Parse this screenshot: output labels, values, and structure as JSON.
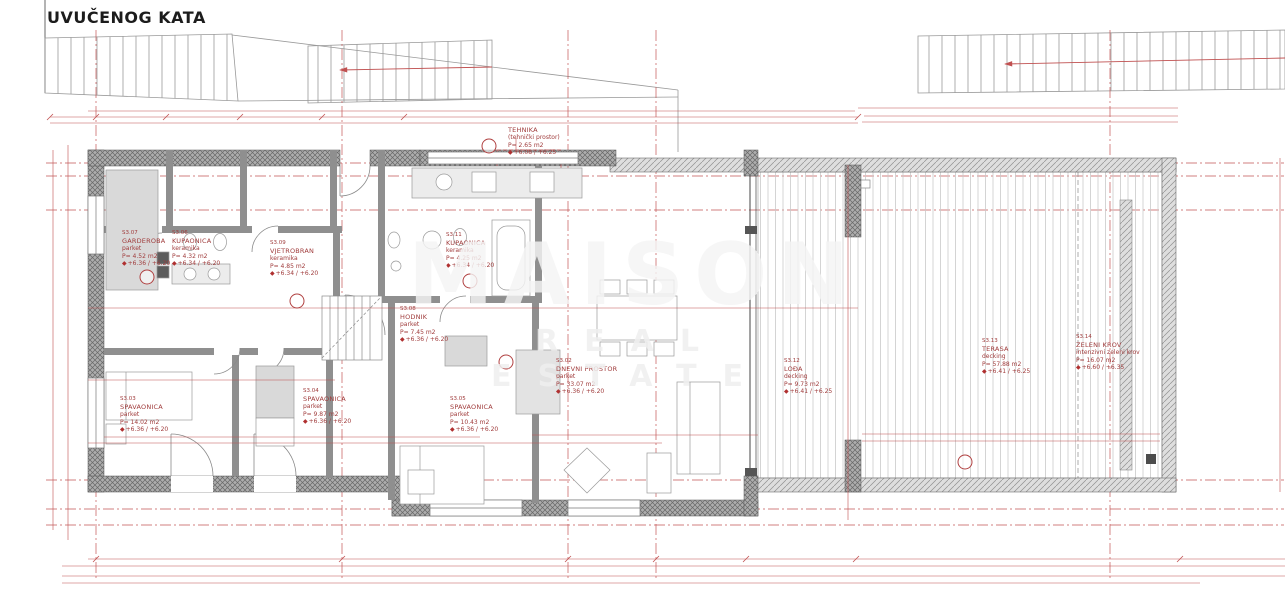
{
  "title": "UVUČENOG KATA",
  "watermark": {
    "line1": "MAISON",
    "line2": "REAL ESTATE"
  },
  "colors": {
    "dimension_red": "#b04040",
    "wall_gray": "#6a6a6a",
    "furniture_gray": "#d9d9d9",
    "deck_gray": "#c9c9c9",
    "background": "#ffffff"
  },
  "grid": {
    "top": [
      {
        "t": "A",
        "x": 96,
        "y": 27
      },
      {
        "t": "B",
        "x": 342,
        "y": 25
      },
      {
        "t": "C",
        "x": 568,
        "y": 25
      },
      {
        "t": "D",
        "x": 656,
        "y": 25
      },
      {
        "t": "E",
        "x": 1110,
        "y": 25
      }
    ],
    "bottom": [
      {
        "t": "A",
        "x": 96,
        "y": 581
      },
      {
        "t": "B",
        "x": 342,
        "y": 581
      },
      {
        "t": "C",
        "x": 568,
        "y": 581
      },
      {
        "t": "D",
        "x": 656,
        "y": 581
      },
      {
        "t": "E",
        "x": 1110,
        "y": 581
      }
    ],
    "left": [
      {
        "t": "6",
        "x": 50,
        "y": 163
      },
      {
        "t": "5",
        "x": 50,
        "y": 176
      },
      {
        "t": "4",
        "x": 50,
        "y": 210
      },
      {
        "t": "3",
        "x": 50,
        "y": 480
      },
      {
        "t": "2",
        "x": 50,
        "y": 509
      },
      {
        "t": "1",
        "x": 50,
        "y": 525
      }
    ],
    "right": [
      {
        "t": "6",
        "x": 1277,
        "y": 163
      },
      {
        "t": "5",
        "x": 1277,
        "y": 176
      },
      {
        "t": "4",
        "x": 1277,
        "y": 210
      },
      {
        "t": "3",
        "x": 1277,
        "y": 480
      },
      {
        "t": "2",
        "x": 1277,
        "y": 509
      },
      {
        "t": "1",
        "x": 1277,
        "y": 525
      }
    ]
  },
  "rooms": [
    {
      "code": "S3.07",
      "name": "GARDEROBA",
      "finish": "parket",
      "area": "P= 4.52 m2",
      "levels": "+6.36 / +6.20",
      "x": 122,
      "y": 230
    },
    {
      "code": "S3.06",
      "name": "KUPAONICA",
      "finish": "keramika",
      "area": "P= 4.32 m2",
      "levels": "+6.34 / +6.20",
      "x": 172,
      "y": 230
    },
    {
      "code": "S3.09",
      "name": "VJETROBRAN",
      "finish": "keramika",
      "area": "P= 4.85 m2",
      "levels": "+6.34 / +6.20",
      "x": 270,
      "y": 240
    },
    {
      "code": "S3.11",
      "name": "KUPAONICA",
      "finish": "keramika",
      "area": "P= 4.25 m2",
      "levels": "+6.34 / +6.20",
      "x": 446,
      "y": 232
    },
    {
      "code": "",
      "name": "TEHNIKA",
      "finish": "(tehnički prostor)",
      "area": "P= 2.65 m2",
      "levels": "+6.08 / +6.25",
      "x": 508,
      "y": 126
    },
    {
      "code": "S3.08",
      "name": "HODNIK",
      "finish": "parket",
      "area": "P= 7.45 m2",
      "levels": "+6.36 / +6.20",
      "x": 400,
      "y": 306
    },
    {
      "code": "S3.02",
      "name": "DNEVNI PROSTOR",
      "finish": "parket",
      "area": "P= 33.07 m2",
      "levels": "+6.36 / +6.20",
      "x": 556,
      "y": 358
    },
    {
      "code": "S3.03",
      "name": "SPAVAONICA",
      "finish": "parket",
      "area": "P= 14.02 m2",
      "levels": "+6.36 / +6.20",
      "x": 120,
      "y": 396
    },
    {
      "code": "S3.04",
      "name": "SPAVAONICA",
      "finish": "parket",
      "area": "P= 9.87 m2",
      "levels": "+6.36 / +6.20",
      "x": 303,
      "y": 388
    },
    {
      "code": "S3.05",
      "name": "SPAVAONICA",
      "finish": "parket",
      "area": "P= 10.43 m2",
      "levels": "+6.36 / +6.20",
      "x": 450,
      "y": 396
    },
    {
      "code": "S3.12",
      "name": "LOĐA",
      "finish": "decking",
      "area": "P= 9.73 m2",
      "levels": "+6.41 / +6.25",
      "x": 784,
      "y": 358
    },
    {
      "code": "S3.13",
      "name": "TERASA",
      "finish": "decking",
      "area": "P= 57.88 m2",
      "levels": "+6.41 / +6.25",
      "x": 982,
      "y": 338
    },
    {
      "code": "S3.14",
      "name": "ZELENI KROV",
      "finish": "intenzivni zeleni krov",
      "area": "P= 16.07 m2",
      "levels": "+6.60 / +6.35",
      "x": 1076,
      "y": 334
    }
  ],
  "dims": [
    {
      "t": "208.5",
      "x": 96,
      "y": 117
    },
    {
      "t": "380",
      "x": 166,
      "y": 111
    },
    {
      "t": "40",
      "x": 188,
      "y": 117
    },
    {
      "t": "111.5",
      "x": 227,
      "y": 117
    },
    {
      "t": "216",
      "x": 172,
      "y": 123
    },
    {
      "t": "16",
      "x": 240,
      "y": 123
    },
    {
      "t": "147",
      "x": 282,
      "y": 112
    },
    {
      "t": "45",
      "x": 261,
      "y": 117
    },
    {
      "t": "38",
      "x": 292,
      "y": 117
    },
    {
      "t": "179",
      "x": 261,
      "y": 123
    },
    {
      "t": "15",
      "x": 323,
      "y": 117
    },
    {
      "t": "226",
      "x": 363,
      "y": 117
    },
    {
      "t": "182",
      "x": 362,
      "y": 123
    },
    {
      "t": "15",
      "x": 404,
      "y": 123
    },
    {
      "t": "640",
      "x": 452,
      "y": 108
    },
    {
      "t": "386",
      "x": 494,
      "y": 115
    },
    {
      "t": "418",
      "x": 494,
      "y": 121
    },
    {
      "t": "25",
      "x": 585,
      "y": 115
    },
    {
      "t": "16",
      "x": 583,
      "y": 121
    },
    {
      "t": "161",
      "x": 623,
      "y": 108
    },
    {
      "t": "831",
      "x": 727,
      "y": 115
    },
    {
      "t": "834",
      "x": 721,
      "y": 121
    },
    {
      "t": "15",
      "x": 855,
      "y": 121
    },
    {
      "t": "1206.5",
      "x": 917,
      "y": 108
    },
    {
      "t": "726.5",
      "x": 1021,
      "y": 116
    },
    {
      "t": "743.5",
      "x": 1019,
      "y": 122
    },
    {
      "t": "76",
      "x": 115,
      "y": 307
    },
    {
      "t": "100",
      "x": 298,
      "y": 307
    },
    {
      "t": "114",
      "x": 428,
      "y": 310
    },
    {
      "t": "90",
      "x": 470,
      "y": 309
    },
    {
      "t": "15",
      "x": 522,
      "y": 310
    },
    {
      "t": "457",
      "x": 636,
      "y": 309
    },
    {
      "t": "110",
      "x": 607,
      "y": 316,
      "r": 1
    },
    {
      "t": "212",
      "x": 797,
      "y": 309
    },
    {
      "t": "303.5",
      "x": 166,
      "y": 379
    },
    {
      "t": "110",
      "x": 227,
      "y": 380
    },
    {
      "t": "42.5",
      "x": 243,
      "y": 380
    },
    {
      "t": "90",
      "x": 307,
      "y": 380
    },
    {
      "t": "350",
      "x": 347,
      "y": 408,
      "r": 1
    },
    {
      "t": "773",
      "x": 51,
      "y": 330,
      "r": 1
    },
    {
      "t": "530.5",
      "x": 727,
      "y": 358,
      "r": 1
    },
    {
      "t": "528.5",
      "x": 840,
      "y": 358,
      "r": 1
    },
    {
      "t": "212",
      "x": 852,
      "y": 300,
      "r": 1
    },
    {
      "t": "338",
      "x": 176,
      "y": 437
    },
    {
      "t": "323",
      "x": 325,
      "y": 436
    },
    {
      "t": "121",
      "x": 127,
      "y": 443
    },
    {
      "t": "160",
      "x": 190,
      "y": 443
    },
    {
      "t": "75",
      "x": 237,
      "y": 443
    },
    {
      "t": "75",
      "x": 273,
      "y": 443
    },
    {
      "t": "180",
      "x": 308,
      "y": 443
    },
    {
      "t": "279",
      "x": 469,
      "y": 437
    },
    {
      "t": "108",
      "x": 425,
      "y": 443
    },
    {
      "t": "160",
      "x": 484,
      "y": 443
    },
    {
      "t": "140",
      "x": 562,
      "y": 443
    },
    {
      "t": "326",
      "x": 653,
      "y": 443
    },
    {
      "t": "407",
      "x": 635,
      "y": 435
    },
    {
      "t": "623",
      "x": 925,
      "y": 434
    },
    {
      "t": "620",
      "x": 925,
      "y": 441
    },
    {
      "t": "15",
      "x": 96,
      "y": 559
    },
    {
      "t": "688",
      "x": 245,
      "y": 559
    },
    {
      "t": "150",
      "x": 119,
      "y": 567
    },
    {
      "t": "100",
      "x": 184,
      "y": 567
    },
    {
      "t": "170",
      "x": 256,
      "y": 567
    },
    {
      "t": "160",
      "x": 325,
      "y": 567
    },
    {
      "t": "77",
      "x": 390,
      "y": 567
    },
    {
      "t": "15",
      "x": 402,
      "y": 559
    },
    {
      "t": "140",
      "x": 447,
      "y": 567
    },
    {
      "t": "180",
      "x": 523,
      "y": 567
    },
    {
      "t": "170",
      "x": 590,
      "y": 567
    },
    {
      "t": "218",
      "x": 660,
      "y": 567
    },
    {
      "t": "705",
      "x": 360,
      "y": 576
    },
    {
      "t": "726",
      "x": 562,
      "y": 559
    },
    {
      "t": "20",
      "x": 746,
      "y": 559
    },
    {
      "t": "233",
      "x": 801,
      "y": 559
    },
    {
      "t": "15",
      "x": 856,
      "y": 559
    },
    {
      "t": "45",
      "x": 743,
      "y": 566
    },
    {
      "t": "212",
      "x": 799,
      "y": 566
    },
    {
      "t": "40",
      "x": 855,
      "y": 566
    },
    {
      "t": "743.5",
      "x": 1019,
      "y": 559
    },
    {
      "t": "724.5",
      "x": 1021,
      "y": 566
    },
    {
      "t": "724.5",
      "x": 1023,
      "y": 576
    },
    {
      "t": "1083",
      "x": 628,
      "y": 577
    },
    {
      "t": "2622.5",
      "x": 632,
      "y": 583
    }
  ],
  "notes": [
    {
      "t": "13 Visina",
      "x": 441,
      "y": 64
    },
    {
      "t": "16.5/28.0",
      "x": 441,
      "y": 72
    },
    {
      "t": "gph 40 cm",
      "x": 421,
      "y": 157
    },
    {
      "t": "ventilacija",
      "x": 768,
      "y": 183
    },
    {
      "t": "linijska odvodnja",
      "x": 884,
      "y": 287
    },
    {
      "t": "linijska odvodnja",
      "x": 1100,
      "y": 267
    },
    {
      "t": "KAMENA KLUPČICA 8 cm",
      "x": 947,
      "y": 168
    },
    {
      "t": "KAMENA KLUPČICA+2m",
      "x": 1040,
      "y": 484
    },
    {
      "t": "KAMENA KLUPČICA+2m",
      "x": 1168,
      "y": 430,
      "r": 1
    },
    {
      "t": "pp= 65 cm",
      "x": 458,
      "y": 505
    },
    {
      "t": "pp= 65 cm",
      "x": 593,
      "y": 505
    },
    {
      "t": "pp= 0 cm",
      "x": 155,
      "y": 472
    },
    {
      "t": "pp= 0 cm",
      "x": 291,
      "y": 472
    }
  ],
  "codes": [
    {
      "t": "U3",
      "x": 104,
      "y": 297,
      "r": 1
    },
    {
      "t": "U2a",
      "x": 177,
      "y": 303,
      "r": 1
    },
    {
      "t": "U3",
      "x": 246,
      "y": 297,
      "r": 1
    },
    {
      "t": "U1a",
      "x": 228,
      "y": 257
    },
    {
      "t": "U1a",
      "x": 313,
      "y": 246
    },
    {
      "t": "U1a",
      "x": 534,
      "y": 259
    },
    {
      "t": "U2a",
      "x": 494,
      "y": 300,
      "r": 1
    },
    {
      "t": "U1",
      "x": 268,
      "y": 333
    },
    {
      "t": "U1",
      "x": 223,
      "y": 339
    },
    {
      "t": "U1",
      "x": 518,
      "y": 395
    },
    {
      "t": "U1",
      "x": 459,
      "y": 348
    },
    {
      "t": "R3",
      "x": 257,
      "y": 228
    },
    {
      "t": "Z3",
      "x": 763,
      "y": 232
    },
    {
      "t": "Z3",
      "x": 763,
      "y": 487
    }
  ],
  "circles": [
    {
      "t": "1",
      "x": 965,
      "y": 462
    },
    {
      "t": "2",
      "x": 489,
      "y": 146
    },
    {
      "t": "2",
      "x": 147,
      "y": 277
    },
    {
      "t": "3a",
      "x": 470,
      "y": 281
    },
    {
      "t": "6",
      "x": 506,
      "y": 362
    },
    {
      "t": "7",
      "x": 297,
      "y": 301
    }
  ]
}
